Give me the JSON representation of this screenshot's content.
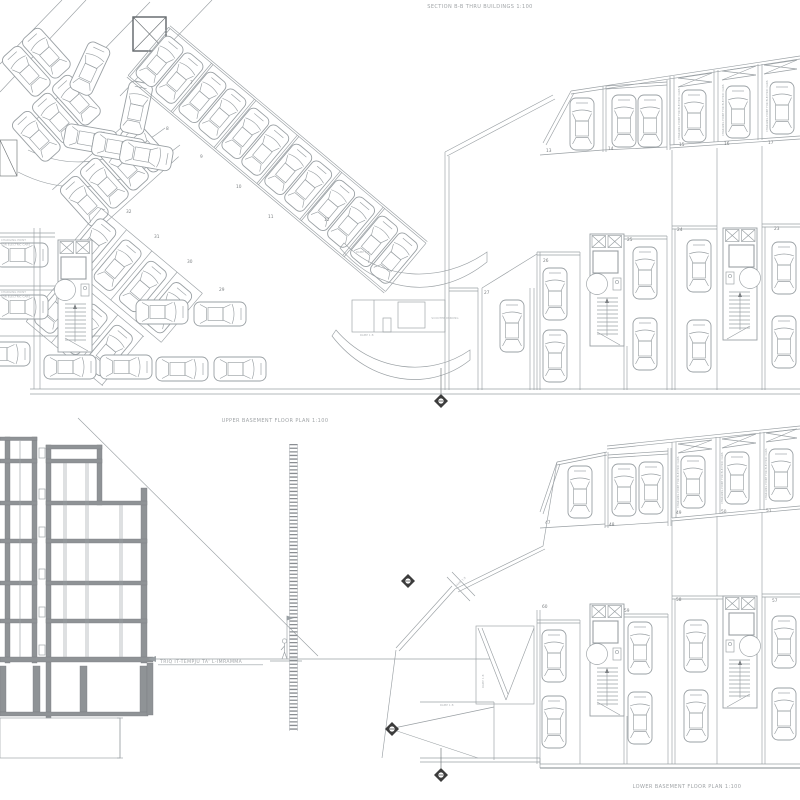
{
  "titles": {
    "section": "SECTION B-B THRU BUILDINGS 1:100",
    "upper_plan": "UPPER BASEMENT FLOOR PLAN 1:100",
    "lower_plan": "LOWER BASEMENT FLOOR PLAN 1:100"
  },
  "labels": {
    "street": "TRIQ IT-TEMPJU TA' L-IMRAMMA",
    "scooter_parking": "SCOOTER PARKING",
    "ramp": "RAMP 1:8",
    "charging_line1": "CHARGING POINT",
    "charging_line2": "FOR ELECTRIC CARS",
    "ev_vertical": "CHARGING POINT FOR ELECTRIC CARS"
  },
  "colors": {
    "line": "#9aa0a4",
    "poche": "#8f9396",
    "text": "#a0a4a7",
    "marker": "#3c3c3c",
    "background": "#ffffff"
  },
  "upper_plan": {
    "diagonal_bays": [
      "7",
      "8",
      "9",
      "10",
      "11",
      "12"
    ],
    "left_diagonal_bays": [
      "32",
      "31",
      "30",
      "29"
    ],
    "garage_bays": [
      "13",
      "14",
      "15",
      "16",
      "17"
    ],
    "mid_bays": [
      "27",
      "26",
      "25",
      "24",
      "23"
    ]
  },
  "lower_plan": {
    "garage_bays": [
      "47",
      "48",
      "49",
      "50",
      "51"
    ],
    "mid_bays": [
      "60",
      "59",
      "58",
      "57"
    ]
  }
}
